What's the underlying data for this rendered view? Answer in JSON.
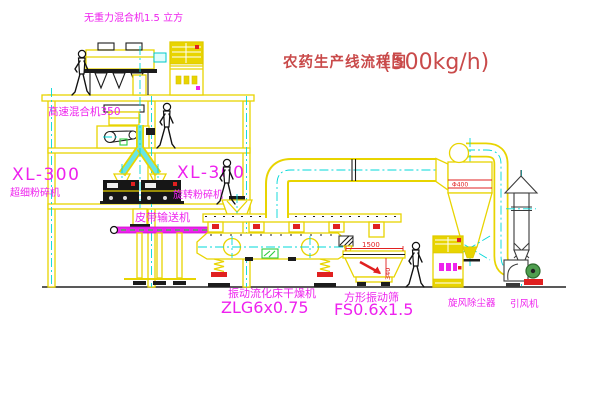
{
  "title": {
    "text": "农药生产线流程图",
    "capacity": "(500kg/h)"
  },
  "labels": {
    "weightless_mixer": "无重力混合机1.5 立方",
    "high_speed_mixer": "高速混合机350",
    "mill_left_model": "XL-300",
    "mill_left_name": "超细粉碎机",
    "mill_right_model": "XL-300",
    "mill_right_name": "旋转粉碎机",
    "belt_conveyor": "皮带输送机",
    "dryer_name": "振动流化床干燥机",
    "dryer_model": "ZLG6x0.75",
    "sieve_name": "方形振动筛",
    "sieve_model": "FS0.6x1.5",
    "cyclone": "旋风除尘器",
    "fan": "引风机"
  },
  "dims": {
    "sieve_length": "1500",
    "sieve_height": "340",
    "cyclone_dia": "Φ400"
  },
  "colors": {
    "line_yellow": "#e8d400",
    "centerline_cyan": "#00d8d8",
    "label_magenta": "#ee22ee",
    "title_red": "#c94a4a",
    "dim_red": "#e02020",
    "machine_black": "#1c1c1c",
    "motor_green": "#4f9e4f"
  }
}
